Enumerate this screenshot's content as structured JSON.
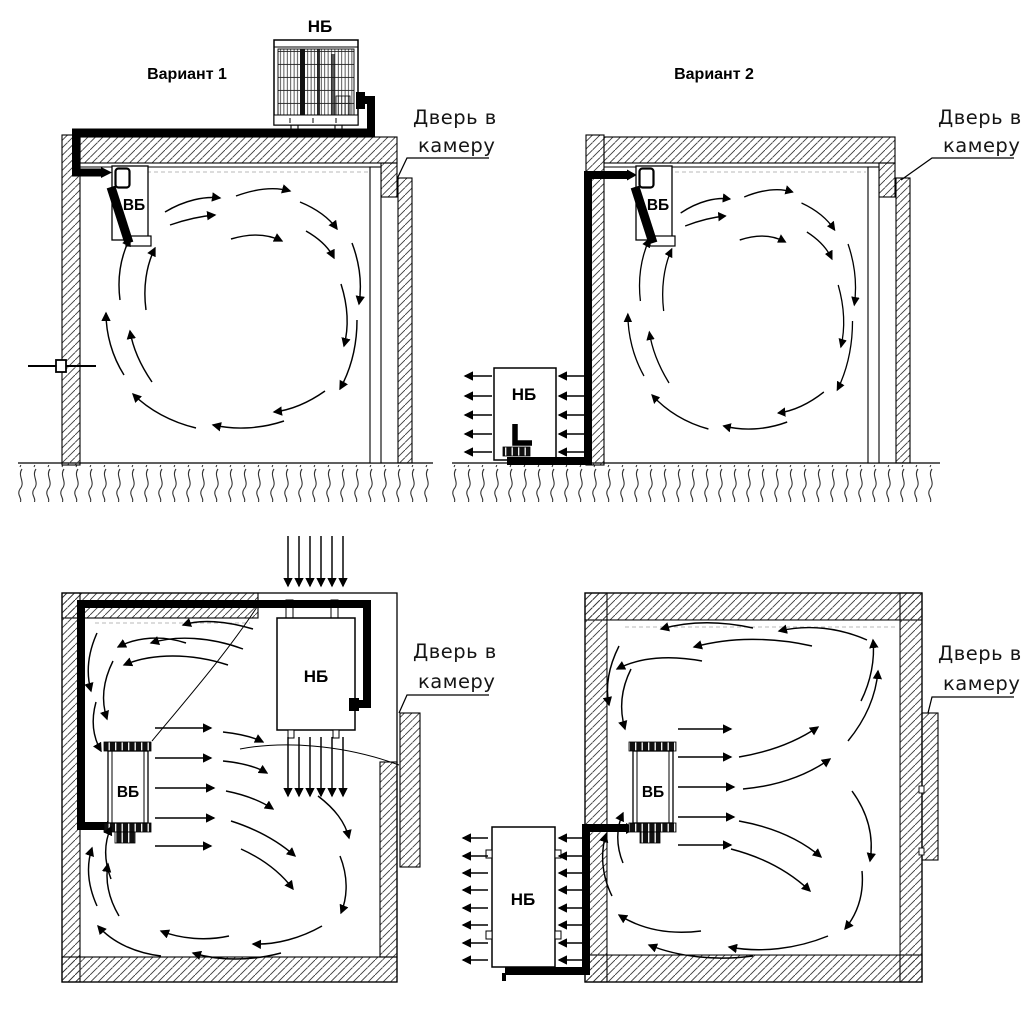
{
  "diagram": {
    "background": "#ffffff",
    "ink_color": "#000000",
    "panels": [
      {
        "title": "Вариант 1",
        "outdoor_unit": "НБ",
        "indoor_unit": "ВБ",
        "door_line1": "Дверь в",
        "door_line2": "камеру"
      },
      {
        "title": "Вариант 2",
        "outdoor_unit": "НБ",
        "indoor_unit": "ВБ",
        "door_line1": "Дверь в",
        "door_line2": "камеру"
      },
      {
        "outdoor_unit": "НБ",
        "indoor_unit": "ВБ",
        "door_line1": "Дверь в",
        "door_line2": "камеру"
      },
      {
        "outdoor_unit": "НБ",
        "indoor_unit": "ВБ",
        "door_line1": "Дверь в",
        "door_line2": "камеру"
      }
    ]
  }
}
